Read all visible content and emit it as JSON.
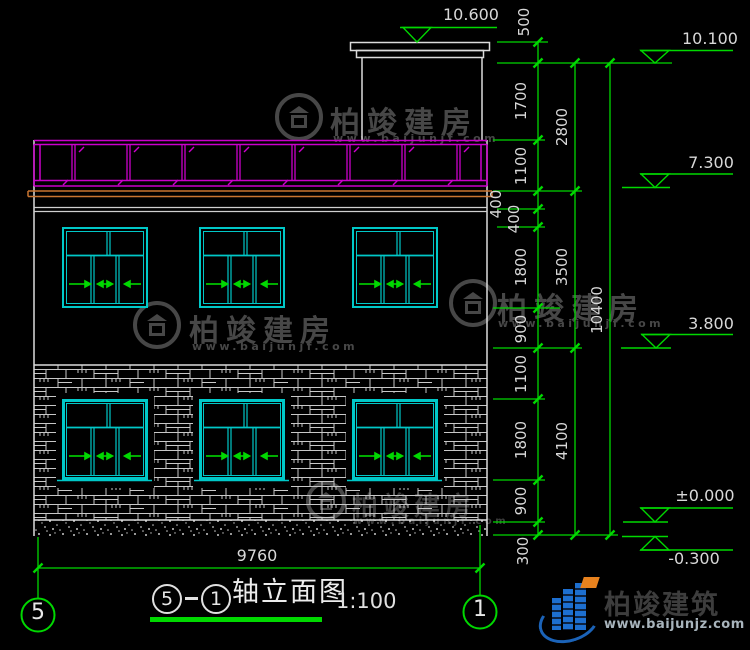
{
  "labels": {
    "top_elevation": "10.600",
    "building_width": "9760"
  },
  "dims": {
    "col1": [
      "500",
      "1700",
      "1100",
      "400",
      "400",
      "1800",
      "900",
      "1100",
      "1800",
      "900",
      "300"
    ],
    "col2": [
      "2800",
      "3500",
      "4100"
    ],
    "col3": [
      "10400"
    ]
  },
  "levels": {
    "roof_access": "10.100",
    "roof": "7.300",
    "floor2": "3.800",
    "ground": "±0.000",
    "below_ground": "-0.300"
  },
  "grid": {
    "left": "5",
    "right": "1"
  },
  "title_block": {
    "bubble_left": "5",
    "bubble_right": "1",
    "name": "轴立面图",
    "scale": "1:100"
  },
  "watermark": {
    "brand": "柏竣建房",
    "url": "www.baijunjf.com"
  },
  "logo": {
    "brand": "柏竣建筑",
    "url": "www.baijunjz.com"
  },
  "colors": {
    "background": "#000000",
    "dimension_green": "#00d800",
    "window_cyan": "#00c8c8",
    "railing_magenta": "#cc00cc",
    "slab_orange": "#c87430",
    "line_white": "#dcdcdc",
    "watermark_gray": "#474747"
  }
}
